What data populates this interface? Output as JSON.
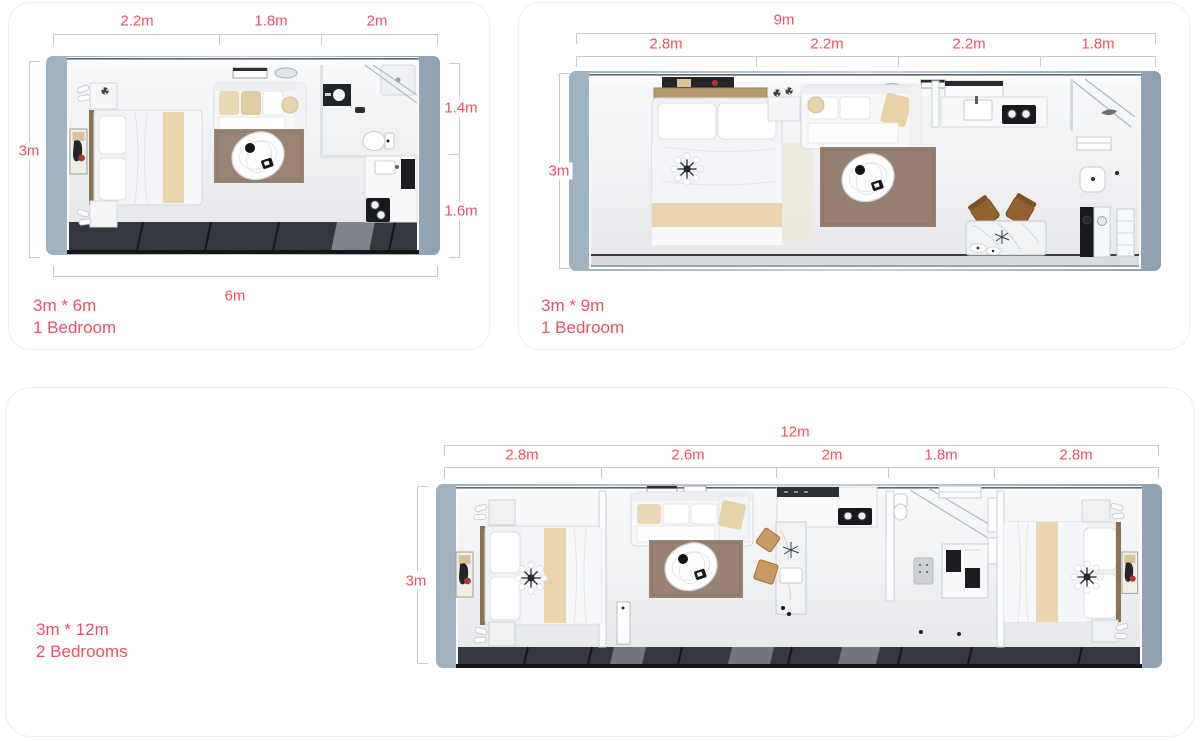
{
  "accent_color": "#ec5063",
  "dim_line_color": "#c8ccd1",
  "plans": [
    {
      "top_dims": [
        "2.2m",
        "1.8m",
        "2m"
      ],
      "left_dim": "3m",
      "right_dims": [
        "1.4m",
        "1.6m"
      ],
      "bottom_dim": "6m",
      "caption": [
        "3m * 6m",
        "1 Bedroom"
      ]
    },
    {
      "total_dim": "9m",
      "top_dims": [
        "2.8m",
        "2.2m",
        "2.2m",
        "1.8m"
      ],
      "left_dim": "3m",
      "caption": [
        "3m * 9m",
        "1 Bedroom"
      ]
    },
    {
      "total_dim": "12m",
      "top_dims": [
        "2.8m",
        "2.6m",
        "2m",
        "1.8m",
        "2.8m"
      ],
      "left_dim": "3m",
      "caption": [
        "3m * 12m",
        "2 Bedrooms"
      ]
    }
  ]
}
